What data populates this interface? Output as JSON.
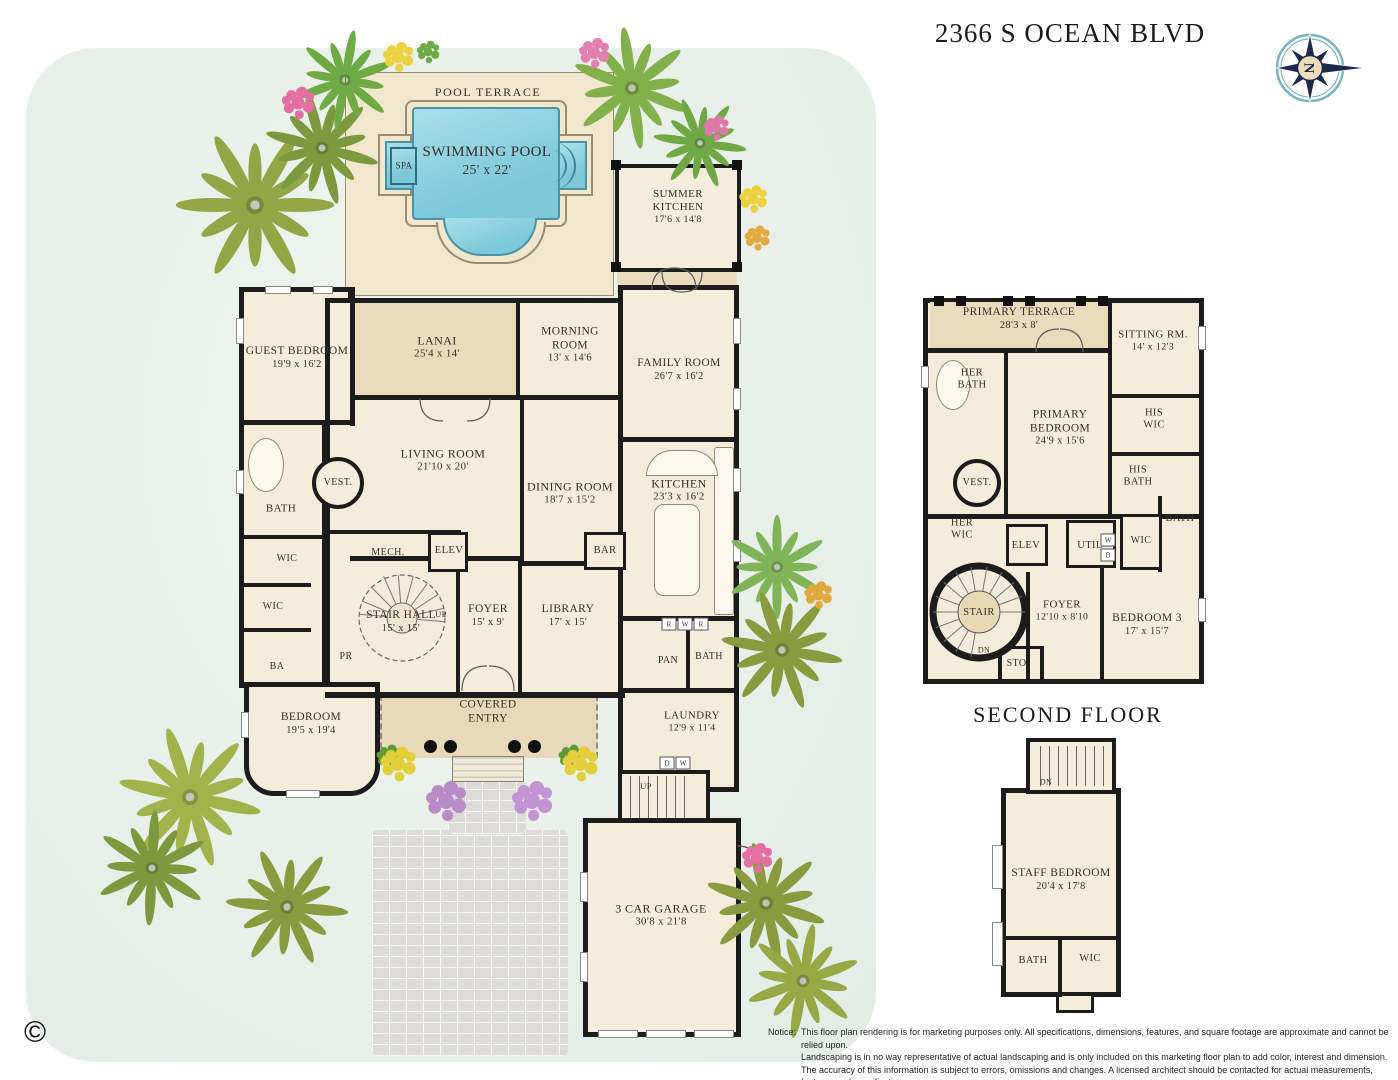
{
  "title": "2366 S OCEAN BLVD",
  "compass": {
    "letter": "N"
  },
  "captions": {
    "second_floor": "SECOND FLOOR"
  },
  "copyright_symbol": "©",
  "notice": {
    "label": "Notice:",
    "lines": [
      "This floor plan rendering is for marketing purposes only. All specifications, dimensions, features, and square footage are approximate and cannot be relied upon.",
      "Landscaping is in no way representative of actual landscaping and is only included on this marketing floor plan to add color, interest and dimension.",
      "The accuracy of this information is subject to errors, omissions and changes. A licensed architect should be contacted for actual measurements, features and specifications."
    ]
  },
  "colors": {
    "wall": "#1c1c1c",
    "room_fill": "#f5eddb",
    "terrace_tan": "#e9dcbd",
    "pool_water": "#8ed1e0",
    "lawn": "#e8f0e9",
    "compass_navy": "#1e2a4d",
    "compass_ring_teal": "#79b4c0"
  },
  "first_floor": {
    "rooms": [
      {
        "label": "POOL TERRACE",
        "x": 488,
        "y": 92,
        "fs": 12,
        "ls": 1.5
      },
      {
        "label": "SWIMMING POOL",
        "dims": "25' x 22'",
        "x": 487,
        "y": 161,
        "fs": 15
      },
      {
        "label": "SPA",
        "x": 404,
        "y": 166,
        "fs": 9
      },
      {
        "label": "SUMMER\nKITCHEN",
        "dims": "17'6 x 14'8",
        "x": 678,
        "y": 207,
        "fs": 11
      },
      {
        "label": "GUEST BEDROOM",
        "dims": "19'9 x 16'2",
        "x": 297,
        "y": 358,
        "fs": 11.5
      },
      {
        "label": "LANAI",
        "dims": "25'4 x 14'",
        "x": 437,
        "y": 347,
        "fs": 12
      },
      {
        "label": "MORNING\nROOM",
        "dims": "13' x 14'6",
        "x": 570,
        "y": 345,
        "fs": 11.5
      },
      {
        "label": "FAMILY ROOM",
        "dims": "26'7 x 16'2",
        "x": 679,
        "y": 370,
        "fs": 11.5
      },
      {
        "label": "LIVING ROOM",
        "dims": "21'10 x 20'",
        "x": 443,
        "y": 460,
        "fs": 12
      },
      {
        "label": "DINING ROOM",
        "dims": "18'7 x 15'2",
        "x": 570,
        "y": 493,
        "fs": 12
      },
      {
        "label": "KITCHEN",
        "dims": "23'3 x 16'2",
        "x": 679,
        "y": 490,
        "fs": 12
      },
      {
        "label": "VEST.",
        "x": 338,
        "y": 483,
        "fs": 10
      },
      {
        "label": "BATH",
        "x": 281,
        "y": 509,
        "fs": 11
      },
      {
        "label": "WIC",
        "x": 287,
        "y": 559,
        "fs": 10
      },
      {
        "label": "WIC",
        "x": 273,
        "y": 607,
        "fs": 10
      },
      {
        "label": "BA",
        "x": 277,
        "y": 667,
        "fs": 10
      },
      {
        "label": "PR",
        "x": 346,
        "y": 657,
        "fs": 10
      },
      {
        "label": "MECH.",
        "x": 388,
        "y": 553,
        "fs": 10
      },
      {
        "label": "ELEV",
        "x": 449,
        "y": 551,
        "fs": 10.5
      },
      {
        "label": "BAR",
        "x": 605,
        "y": 551,
        "fs": 10.5
      },
      {
        "label": "STAIR HALL",
        "dims": "15' x 15'",
        "x": 401,
        "y": 622,
        "fs": 11.5
      },
      {
        "label": "UP",
        "x": 441,
        "y": 614,
        "fs": 8.5
      },
      {
        "label": "FOYER",
        "dims": "15' x 9'",
        "x": 488,
        "y": 616,
        "fs": 11.5
      },
      {
        "label": "LIBRARY",
        "dims": "17' x 15'",
        "x": 568,
        "y": 616,
        "fs": 11.5
      },
      {
        "label": "PAN",
        "x": 668,
        "y": 661,
        "fs": 10
      },
      {
        "label": "BATH",
        "x": 709,
        "y": 657,
        "fs": 10
      },
      {
        "label": "BEDROOM",
        "dims": "19'5 x 19'4",
        "x": 311,
        "y": 724,
        "fs": 11.5
      },
      {
        "label": "COVERED\nENTRY",
        "x": 488,
        "y": 712,
        "fs": 11.5
      },
      {
        "label": "LAUNDRY",
        "dims": "12'9 x 11'4",
        "x": 692,
        "y": 722,
        "fs": 11
      },
      {
        "label": "UP",
        "x": 646,
        "y": 786,
        "fs": 8.5
      },
      {
        "label": "3 CAR GARAGE",
        "dims": "30'8 x 21'8",
        "x": 661,
        "y": 915,
        "fs": 12
      }
    ]
  },
  "second_floor": {
    "rooms": [
      {
        "label": "PRIMARY TERRACE",
        "dims": "28'3 x 8'",
        "x": 1019,
        "y": 319,
        "fs": 11.5
      },
      {
        "label": "SITTING RM.",
        "dims": "14' x 12'3",
        "x": 1153,
        "y": 341,
        "fs": 11
      },
      {
        "label": "HER\nBATH",
        "x": 972,
        "y": 380,
        "fs": 10.5
      },
      {
        "label": "PRIMARY\nBEDROOM",
        "dims": "24'9 x 15'6",
        "x": 1060,
        "y": 428,
        "fs": 11.5
      },
      {
        "label": "HIS\nWIC",
        "x": 1154,
        "y": 420,
        "fs": 10.5
      },
      {
        "label": "HIS\nBATH",
        "x": 1138,
        "y": 477,
        "fs": 10.5
      },
      {
        "label": "VEST.",
        "x": 977,
        "y": 483,
        "fs": 10
      },
      {
        "label": "HER\nWIC",
        "x": 962,
        "y": 530,
        "fs": 10.5
      },
      {
        "label": "ELEV",
        "x": 1026,
        "y": 546,
        "fs": 10.5
      },
      {
        "label": "UTIL",
        "x": 1090,
        "y": 546,
        "fs": 10.5
      },
      {
        "label": "WIC",
        "x": 1141,
        "y": 541,
        "fs": 10
      },
      {
        "label": "BATH",
        "x": 1180,
        "y": 519,
        "fs": 10.5
      },
      {
        "label": "STAIR",
        "x": 979,
        "y": 613,
        "fs": 10.5
      },
      {
        "label": "DN",
        "x": 984,
        "y": 650,
        "fs": 8
      },
      {
        "label": "STO.",
        "x": 1018,
        "y": 664,
        "fs": 10
      },
      {
        "label": "FOYER",
        "dims": "12'10 x 8'10",
        "x": 1062,
        "y": 611,
        "fs": 11
      },
      {
        "label": "BEDROOM 3",
        "dims": "17' x 15'7",
        "x": 1147,
        "y": 625,
        "fs": 11.5
      }
    ]
  },
  "staff_suite": {
    "rooms": [
      {
        "label": "DN",
        "x": 1046,
        "y": 782,
        "fs": 8
      },
      {
        "label": "STAFF BEDROOM",
        "dims": "20'4 x 17'8",
        "x": 1061,
        "y": 880,
        "fs": 11.5
      },
      {
        "label": "BATH",
        "x": 1033,
        "y": 961,
        "fs": 10.5
      },
      {
        "label": "WIC",
        "x": 1090,
        "y": 959,
        "fs": 10.5
      }
    ]
  },
  "appliances": [
    {
      "t": "R",
      "x": 669,
      "y": 624
    },
    {
      "t": "W",
      "x": 685,
      "y": 624
    },
    {
      "t": "R",
      "x": 701,
      "y": 624
    },
    {
      "t": "D",
      "x": 667,
      "y": 763
    },
    {
      "t": "W",
      "x": 683,
      "y": 763
    },
    {
      "t": "W",
      "x": 1108,
      "y": 540
    },
    {
      "t": "D",
      "x": 1108,
      "y": 555
    }
  ]
}
